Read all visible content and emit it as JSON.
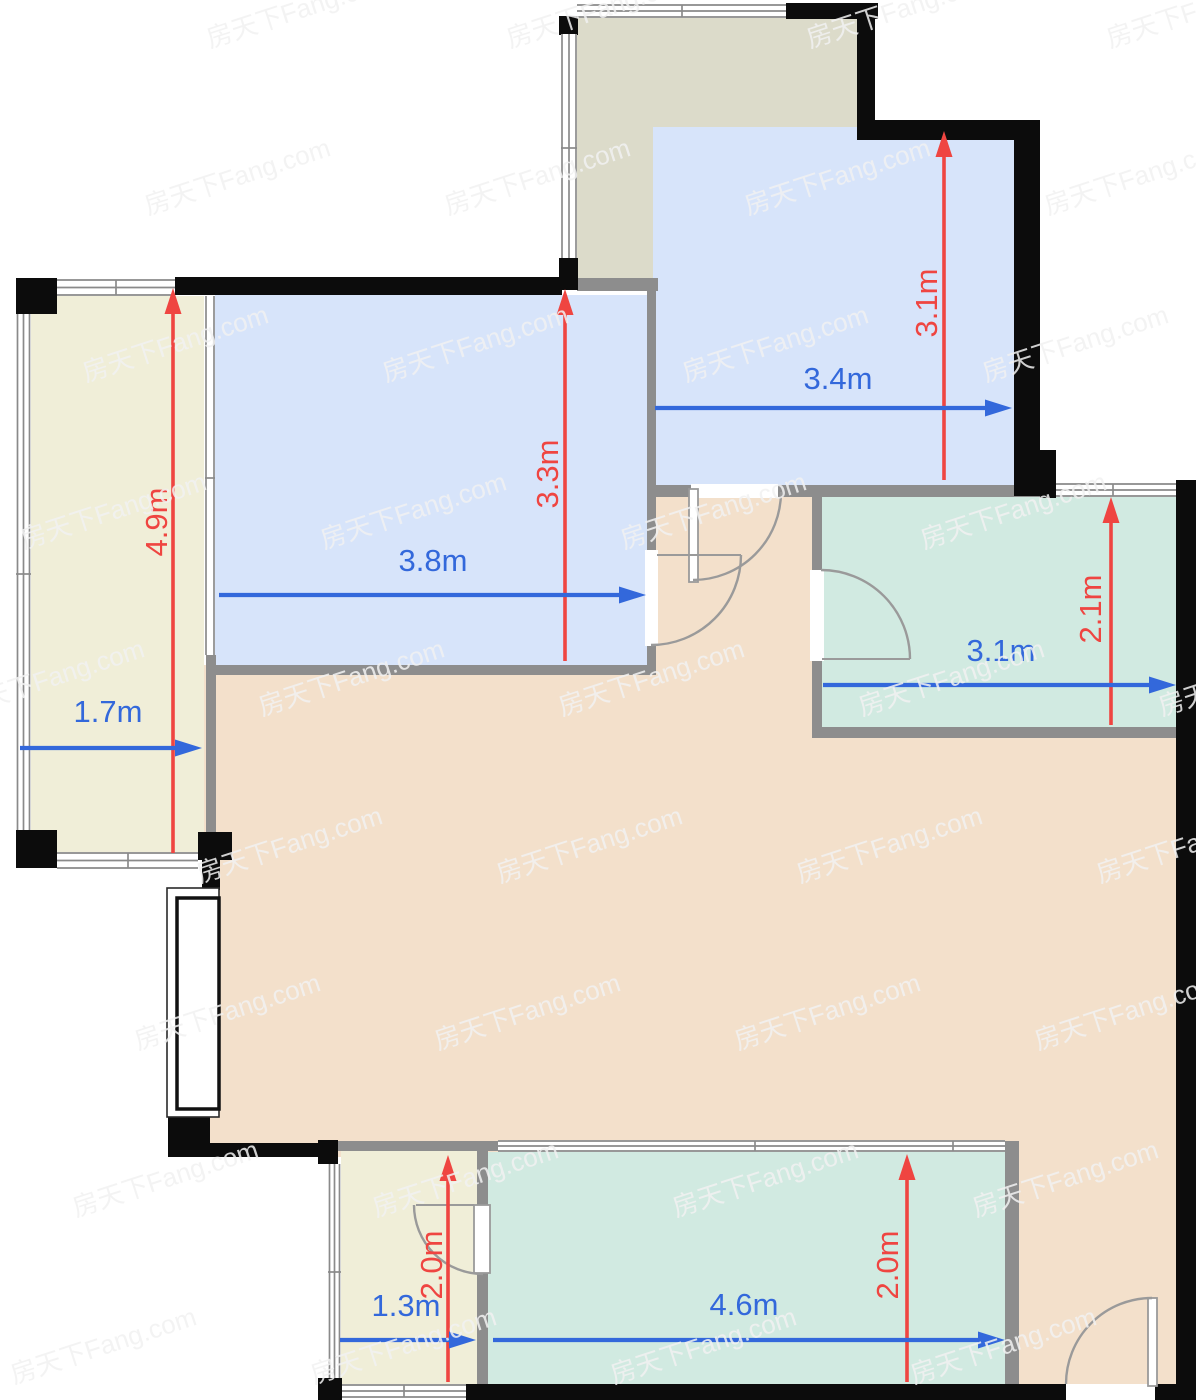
{
  "watermark": {
    "text": "房天下Fang.com"
  },
  "colors": {
    "balcony_left_fill": "#f0eed8",
    "balcony_top_fill": "#dcdbca",
    "bedroom_fill": "#d7e4fa",
    "bath_fill": "#d1eae1",
    "living_fill": "#f3e0cb",
    "wall_black": "#0c0c0c",
    "wall_gray": "#8d8d8d",
    "window_line": "#8a8a8a",
    "door_line": "#9a9a9a",
    "dim_red": "#ef4541",
    "dim_blue": "#3368db",
    "watermark": "#f2f2f2"
  },
  "dimensions": {
    "balcony_left": {
      "width": "1.7m",
      "height": "4.9m"
    },
    "bedroom_left": {
      "width": "3.8m",
      "height": "3.3m"
    },
    "bedroom_right": {
      "width": "3.4m",
      "height": "3.1m"
    },
    "bathroom": {
      "width": "3.1m",
      "height": "2.1m"
    },
    "storage_bottom": {
      "width": "1.3m",
      "height": "2.0m"
    },
    "balcony_bottom": {
      "width": "4.6m",
      "height": "2.0m"
    }
  }
}
